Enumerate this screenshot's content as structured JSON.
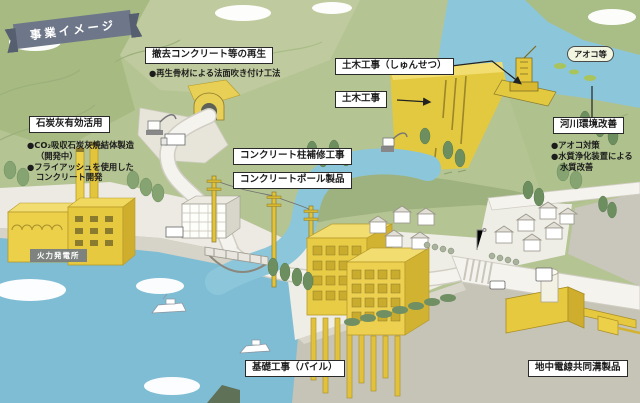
{
  "banner": {
    "label": "事業イメージ"
  },
  "labels": {
    "recycle": {
      "title": "撤去コンクリート等の再生",
      "bullets": [
        "●再生骨材による法面吹き付け工法"
      ]
    },
    "dredge": {
      "title": "土木工事（しゅんせつ）"
    },
    "civil": {
      "title": "土木工事"
    },
    "aoko": {
      "title": "アオコ等"
    },
    "river": {
      "title": "河川環境改善",
      "bullets": [
        "●アオコ対策",
        "●水質浄化装置による",
        "水質改善"
      ]
    },
    "coalash": {
      "title": "石炭灰有効活用",
      "bullets": [
        "●CO₂吸収石炭灰焼結体製造",
        "（開発中）",
        "●フライアッシュを使用した",
        "コンクリート開発"
      ]
    },
    "pole_repair": {
      "title": "コンクリート柱補修工事"
    },
    "pole_product": {
      "title": "コンクリートポール製品"
    },
    "foundation": {
      "title": "基礎工事（パイル）"
    },
    "duct": {
      "title": "地中電線共同溝製品"
    },
    "power_plant": {
      "title": "火力発電所"
    }
  },
  "colors": {
    "banner": "#6e7789",
    "hill_green": "#b5c493",
    "sea_blue": "#7fbdd5",
    "river_blue": "#8cc6da",
    "accent_yellow": "#e7c93f",
    "ground_light": "#eceae3",
    "underground_gray": "#c6c3b7",
    "label_border": "#2a2a2a"
  }
}
